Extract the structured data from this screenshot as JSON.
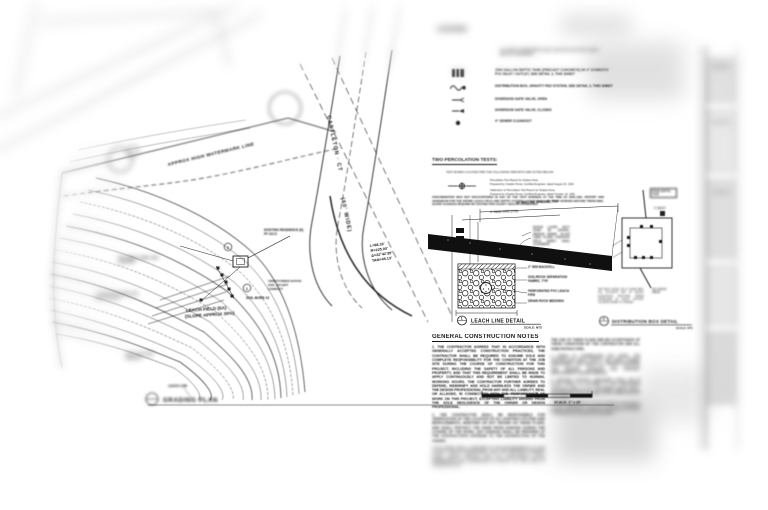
{
  "plan": {
    "watermark_label": "APPROX HIGH WATERMARK LINE",
    "street_name": "CASTLETON · CT",
    "street_width": "(60' WIDE)",
    "leach_field_line1": "LEACH FIELD (5A)",
    "leach_field_line2": "(SLOPE APPROX 30%)",
    "curve_l": "L=88.16'",
    "curve_r": "R=225.00'",
    "curve_delta": "Δ=22°42'35\"",
    "curve_tan": "TAN=45.13'",
    "residence_label": "EXISTING RESIDENCE (E) FF 102.5",
    "native_soil_label": "UNDISTURBED NATIVE SOIL, DO NOT COMPACT",
    "soil_bore_label": "SOIL BORE #2",
    "left_note_a": "SOIL BORE #1 PERC TEST LOCATION",
    "left_note_b": "4\" SOLID PVC SEWER LINE MIN 2% SLOPE",
    "left_note_c": "(E) 24\" OAK TREE DRIPLINE",
    "leach_line_tag": "LEACH LINE",
    "detail_ref_1": "1",
    "detail_ref_2": "2",
    "title": "GRADING PLAN",
    "title_scale": "SCALE: 1\" = 20'"
  },
  "legend": {
    "heading": "LEGEND",
    "note": "ALL SEPTIC COMPONENTS SHALL BE INSTALLED PER COUNTY HEALTH STANDARDS",
    "items": [
      {
        "label": "1500 GALLON SEPTIC TANK (PRECAST CONCRETE) W/ 4\" DOMESTIC PVC INLET / OUTLET, SEE DETAIL 3, THIS SHEET"
      },
      {
        "label": "DISTRIBUTION BOX, GRAVITY FED SYSTEM, SEE DETAIL 2, THIS SHEET"
      },
      {
        "label": "DIVERSION GATE VALVE, OPEN"
      },
      {
        "label": "DIVERSION GATE VALVE, CLOSED"
      },
      {
        "label": "4\" SEWER CLEANOUT"
      }
    ]
  },
  "percolation": {
    "heading": "TWO PERCOLATION TESTS:",
    "intro": "TEST BORES LOCATED PER THE FOLLOWING REPORTS ARE NOTED BELOW",
    "ref1a": "Percolation Test Report for Subject Area,",
    "ref1b": "Prepared by Charles Porter, Certified Engineer, dated August 23, 1991",
    "ref2a": "Addendum to Percolation Test Report for Subject Area,",
    "ref2b": "Prepared by Charles Porter, Certified Engineer, dated October 14, 1991",
    "body": "GROUNDWATER WAS NOT ENCOUNTERED IN ANY OF THE TEST BORINGS AT THE TIME OF DRILLING. REPORT AND ADDENDUM FOR THE ENTIRE LEACH FIELD AND SEPTIC SYSTEM LAYOUT SHALL BE FIELD VERIFIED BEFORE TRENCHING. SCOPE CHANGES REQUIRE RE-TESTING PER COUNTY HEALTH STANDARDS."
  },
  "leach_detail": {
    "dim_top": "10' MIN LINE SPACING, TYP",
    "dim_pipe": "4\" PERF PIPE (TYP)",
    "dim_depth": "2' MIN",
    "callout": "NATIVE LAYER: SILTY SAND W/ GRAVEL, MEDIUM DENSE. PLACE LINES ALONG CONTOUR. FIELD VERIFY FINAL ALIGNMENT.",
    "label_backfill": "2\" MIN BACKFILL",
    "label_fabric": "SOIL/ROCK SEPARATION FABRIC, TYP.",
    "label_pipe": "PERFORATED PVC LEACH PIPE",
    "label_rock": "DRAIN ROCK BEDDING",
    "bubble": "1",
    "title": "LEACH LINE DETAIL",
    "scale": "SCALE: NTS"
  },
  "dist_detail": {
    "label_from": "FROM SEPTIC TANK",
    "label_inlet": "4\" INLET",
    "label_outlet": "TO LEACH FIELD",
    "notes": "SET BOX LEVEL ON 4\" SAND BED. ALL OUTLETS SET AT EQUAL ELEVATION. PROVIDE SPEED LEVELERS AT EACH OUTLET. ACCESS RISER TO GRADE.",
    "bubble": "2",
    "title": "DISTRIBUTION BOX DETAIL",
    "scale": "SCALE: NTS"
  },
  "notes": {
    "heading": "GENERAL CONSTRUCTION NOTES",
    "n1": "1.  THE CONTRACTOR AGREES THAT IN ACCORDANCE WITH GENERALLY ACCEPTED CONSTRUCTION PRACTICES, THE CONTRACTOR SHALL BE REQUIRED TO ASSUME SOLE AND COMPLETE RESPONSIBILITY FOR THE CONDITION AT THE JOB SITE DURING THE COURSE OF CONSTRUCTION FOR THIS PROJECT, INCLUDING THE SAFETY OF ALL PERSONS AND PROPERTY, AND THAT THIS REQUIREMENT SHALL BE MADE TO APPLY CONTINUOUSLY AND NOT BE LIMITED TO NORMAL WORKING HOURS. THE CONTRACTOR FURTHER AGREES TO DEFEND, INDEMNIFY AND HOLD HARMLESS THE OWNER AND THE DESIGN PROFESSIONAL FROM ANY AND ALL LIABILITY, REAL OR ALLEGED, IN CONNECTION WITH THE PERFORMANCE OF WORK ON THIS PROJECT, EXCEPTING LIABILITY ARISING FROM THE SOLE NEGLIGENCE OF THE OWNER OR DESIGN PROFESSIONAL.",
    "n2": "2.  THE CONTRACTOR SHALL BE RESPONSIBLE FOR VERIFICATION OF THE LOCATION OF ALL EXISTING UTILITIES AND IMPROVEMENTS, WHETHER OR NOT SHOWN ON THESE PLANS, AND SHALL PROTECT THE SAME FROM DAMAGE DURING THE COURSE OF THE WORK. ANY DAMAGE SHALL BE REPAIRED AT THE CONTRACTOR'S EXPENSE TO THE SATISFACTION OF THE OWNER.",
    "n3": "3.  ALL WORK SHALL CONFORM TO THE REQUIREMENTS OF THE COUNTY HEALTH DEPARTMENT AND THE UNIFORM PLUMBING CODE, LATEST EDITION, AND ALL APPLICABLE LOCAL ORDINANCES AND STANDARDS IN EFFECT AT THE TIME OF CONSTRUCTION.",
    "c2a": "THE USE OF THESE PLANS IMPLIES ACCEPTANCE OF THESE CONDITIONS BY THE CONTRACTOR AND ALL SUBCONTRACTORS.",
    "c2b": "4.  PRIOR TO COMMENCING ANY WORK, THE CONTRACTOR SHALL NOTIFY THE PUBLIC WORKS DEPARTMENT AND OBTAIN ALL PERMITS REQUIRED FOR GRADING, DRAINAGE AND SANITARY IMPROVEMENTS SHOWN HEREON.",
    "c2c": "5.  EROSION CONTROL MEASURES SHALL BE IN PLACE PRIOR TO OCTOBER 15 AND MAINTAINED THROUGH APRIL 15. ALL DISTURBED AREAS SHALL BE RESEEDED AND MULCHED UPON COMPLETION OF THE WORK.",
    "c2d": "6.  FINAL INSPECTION OF THE SYSTEM IS REQUIRED PRIOR TO BACKFILL. CONTACT THE HEALTH OFFICER A MINIMUM OF 48 HOURS IN ADVANCE."
  }
}
